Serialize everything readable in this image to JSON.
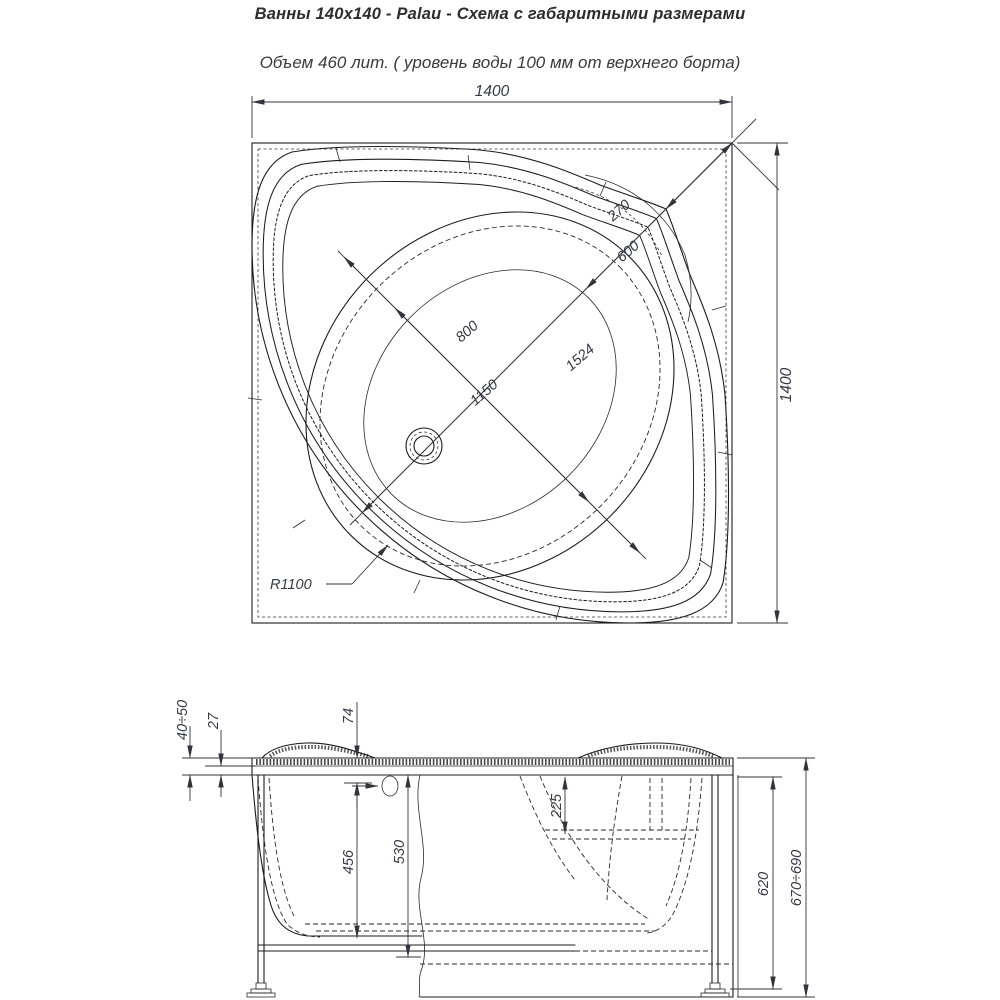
{
  "header": {
    "title": "Ванны 140x140 - Palau - Схема с габаритными размерами",
    "subtitle": "Объем 460 лит. ( уровень воды 100 мм от верхнего борта)"
  },
  "top_view": {
    "dims": {
      "overall_width": "1400",
      "overall_depth": "1400",
      "corner_to_rim": "270",
      "corner_to_basin": "600",
      "basin_bottom_width": "800",
      "basin_top_width": "1150",
      "diagonal_length": "1524",
      "front_radius": "R1100"
    }
  },
  "side_view": {
    "dims": {
      "rim_overhang": "40÷50",
      "rim_thickness": "27",
      "headrest_height": "74",
      "seat_depth": "225",
      "inner_depth": "456",
      "depth_to_frame": "530",
      "frame_height": "620",
      "total_height": "670÷690"
    }
  },
  "colors": {
    "background": "#ffffff",
    "line": "#1c1c1c",
    "dimension_text": "#343a46"
  }
}
